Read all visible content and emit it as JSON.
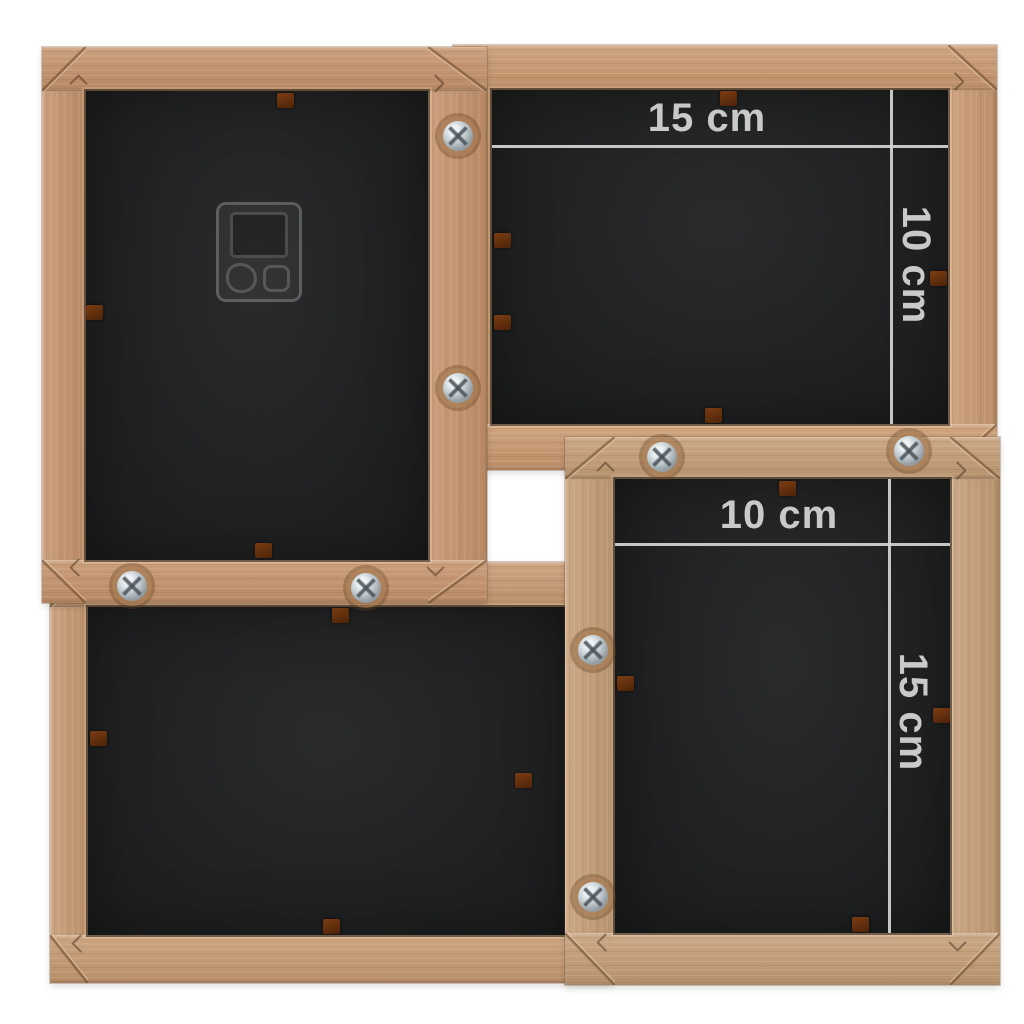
{
  "scene": {
    "type": "product-photo",
    "subject": "back view of a four-photo wooden collage frame with dimension markings",
    "background_color": "#ffffff"
  },
  "colors": {
    "wood": "#c7986f",
    "wood_highlight": "#e3bd94",
    "wood_shadow": "#a27748",
    "backing_panel": "#212223",
    "dimension_line": "#d5d5d5",
    "dimension_text": "#c9c9c9",
    "clip": "#5f2e0e",
    "screw_metal": "#c4cdd2"
  },
  "icons": {
    "screw": "phillips-screw",
    "clip": "backing-clip",
    "hanger": "plastic-hanging-bracket",
    "miter": "miter-joint"
  },
  "annotations": {
    "top_right_frame": {
      "width_label": "15 cm",
      "height_label": "10 cm"
    },
    "bottom_right_frame": {
      "width_label": "10 cm",
      "height_label": "15 cm"
    }
  }
}
